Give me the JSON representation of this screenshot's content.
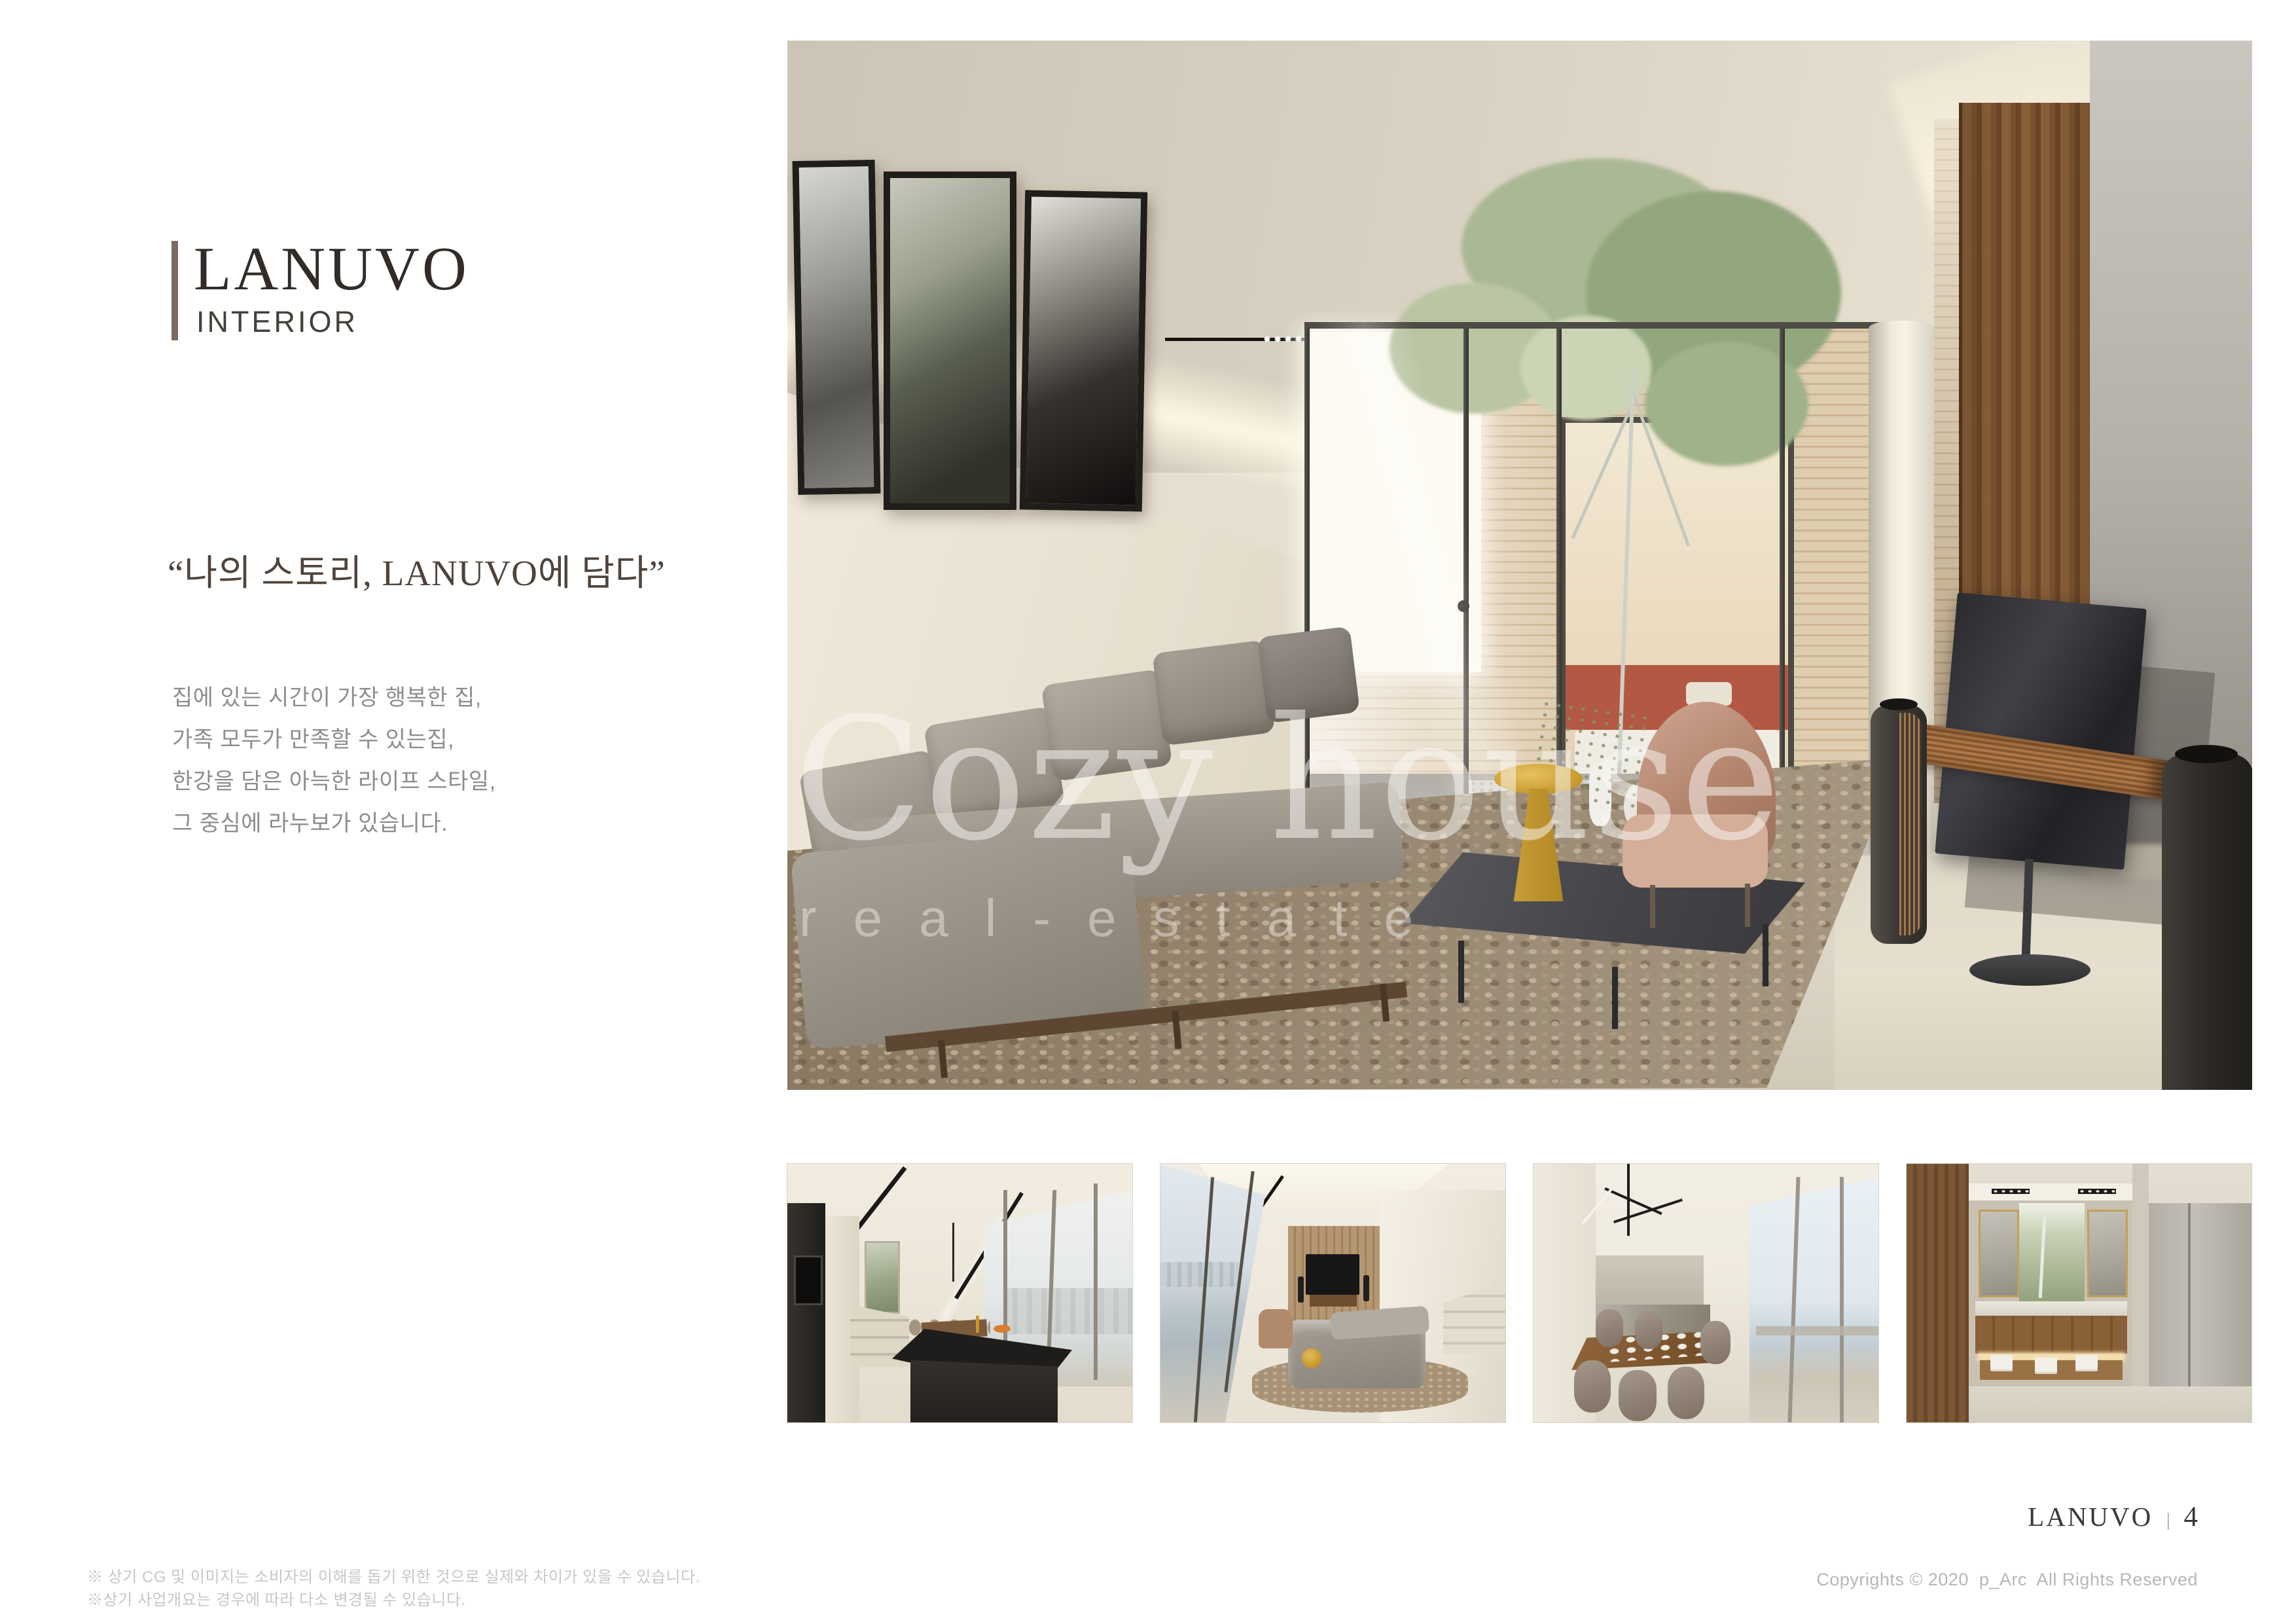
{
  "header": {
    "brand": "LANUVO",
    "section": "INTERIOR"
  },
  "intro": {
    "quote": "“나의 스토리, LANUVO에 담다”",
    "lines": [
      "집에 있는 시간이 가장 행복한 집,",
      "가족 모두가 만족할 수 있는집,",
      "한강을 담은 아늑한 라이프 스타일,",
      "그 중심에 라누보가 있습니다."
    ]
  },
  "watermark": {
    "title": "Cozy house",
    "subtitle": "real-estate"
  },
  "footer": {
    "brand": "LANUVO",
    "separator": "|",
    "page_number": "4",
    "copyright": "Copyrights © 2020  p_Arc  All Rights Reserved",
    "disclaimers": [
      "※ 상기 CG 및 이미지는 소비자의 이해를 돕기 위한 것으로 실제와 차이가 있을 수 있습니다.",
      "※상기 사업개요는 경우에 따라 다소 변경될 수 있습니다."
    ]
  },
  "colors": {
    "accent_bar": "#7b6a61",
    "title": "#322c29",
    "subtitle": "#45403b",
    "quote": "#4f443d",
    "body_text": "#8d8d8d",
    "footer_text": "#3b3835",
    "muted_text": "#bdbbb8"
  }
}
